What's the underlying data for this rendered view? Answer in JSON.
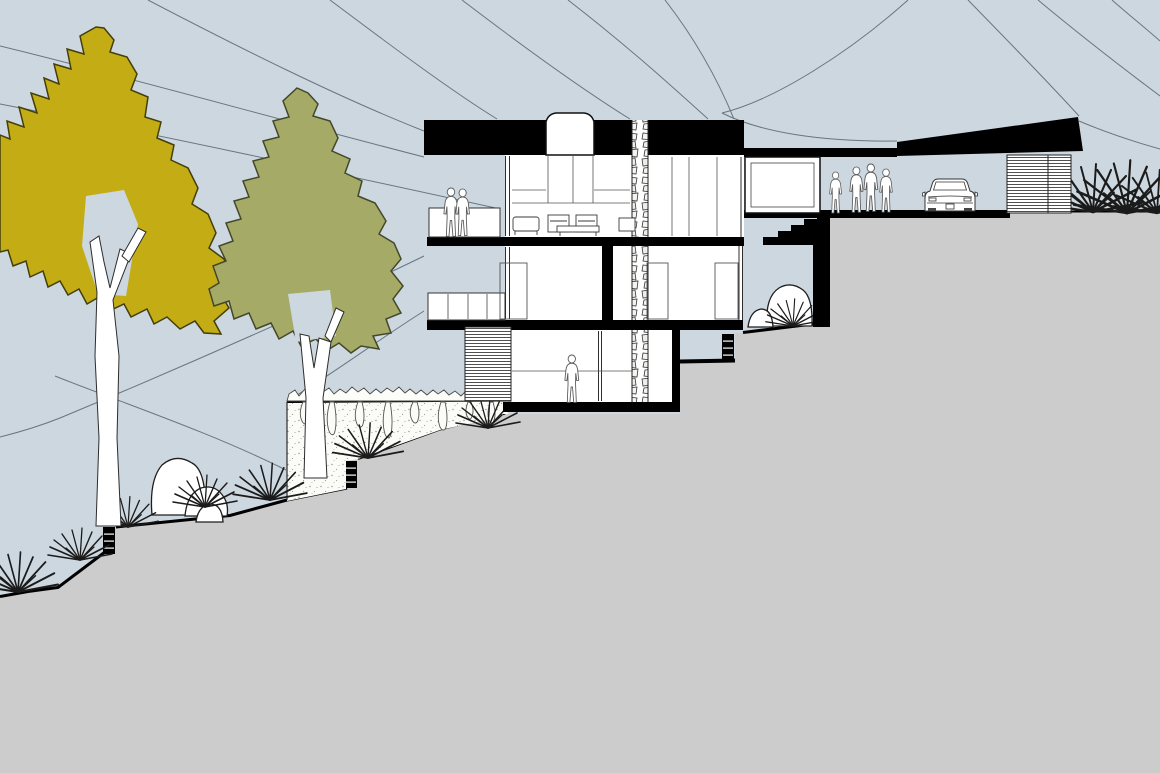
{
  "title": "Hillside residence - architectural cross-section drawing",
  "palette": {
    "sky": "#ccd7df",
    "hill": "#cbcccb",
    "ink": "#000000",
    "contour_line": "#5c6c77",
    "tree_olive": "#c3ac14",
    "tree_olive_outline": "#433e0b",
    "tree_sage": "#a5ab66",
    "tree_sage_outline": "#43482a",
    "stone_outline": "#333333",
    "white": "#ffffff"
  },
  "scene": {
    "type": "section-elevation",
    "building": {
      "levels": 3,
      "elements": [
        "flat black roof slab",
        "arched rooftop skylight",
        "stacked stone chimney",
        "upper balcony with parapet",
        "glazed facades",
        "louvered facade panel",
        "exterior entry stair",
        "carport with louvered screen",
        "planted retaining wall",
        "terraced hillside"
      ]
    },
    "figures": {
      "balcony_couple": 2,
      "entry_group": 4,
      "interior_walker": 1,
      "total": 7
    },
    "vehicle": {
      "type": "car",
      "view": "rear"
    },
    "landscape": {
      "trees": 2,
      "agave_plants": 11,
      "boulder_groups": 2,
      "contour_lines": 15
    }
  }
}
